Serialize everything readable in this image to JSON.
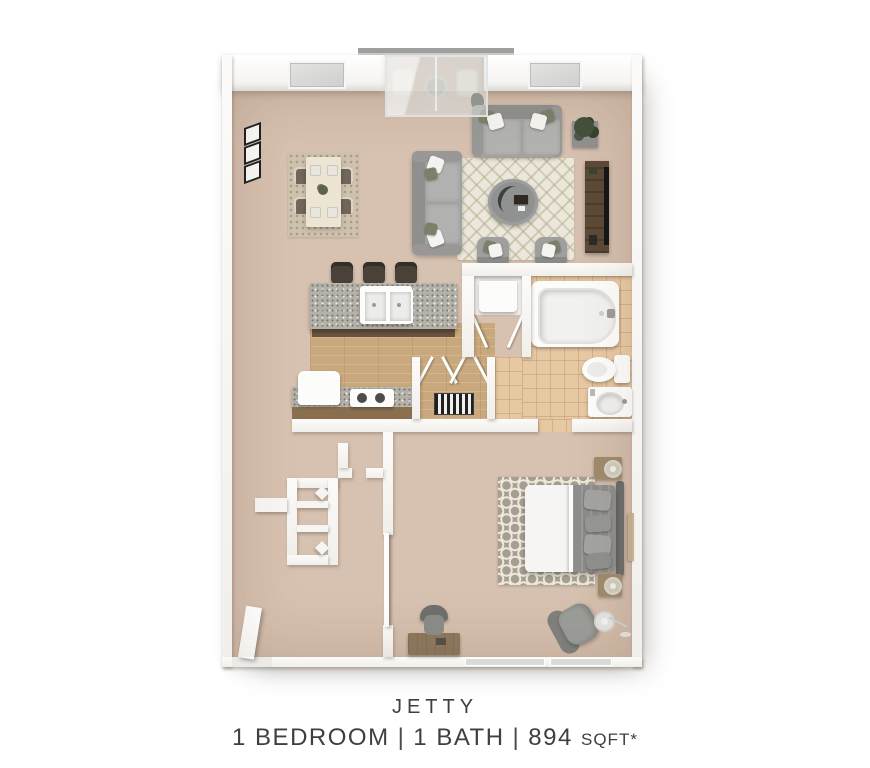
{
  "caption": {
    "name": "JETTY",
    "bedrooms": "1 BEDROOM",
    "sep1": "|",
    "bathrooms": "1 BATH",
    "sep2": "|",
    "area": "894",
    "unit": "SQFT*"
  },
  "colors": {
    "carpet": "#d7c1b0",
    "wood": "#c8a87c",
    "tile": "#e6c8a2",
    "wall": "#fcfbf9",
    "granite": "#b4b1a9",
    "darkwood": "#5c4936",
    "olive": "#7c8068",
    "ruglight": "#ebe7da",
    "rugdark": "#a69e91",
    "ink": "#3f3f41"
  }
}
